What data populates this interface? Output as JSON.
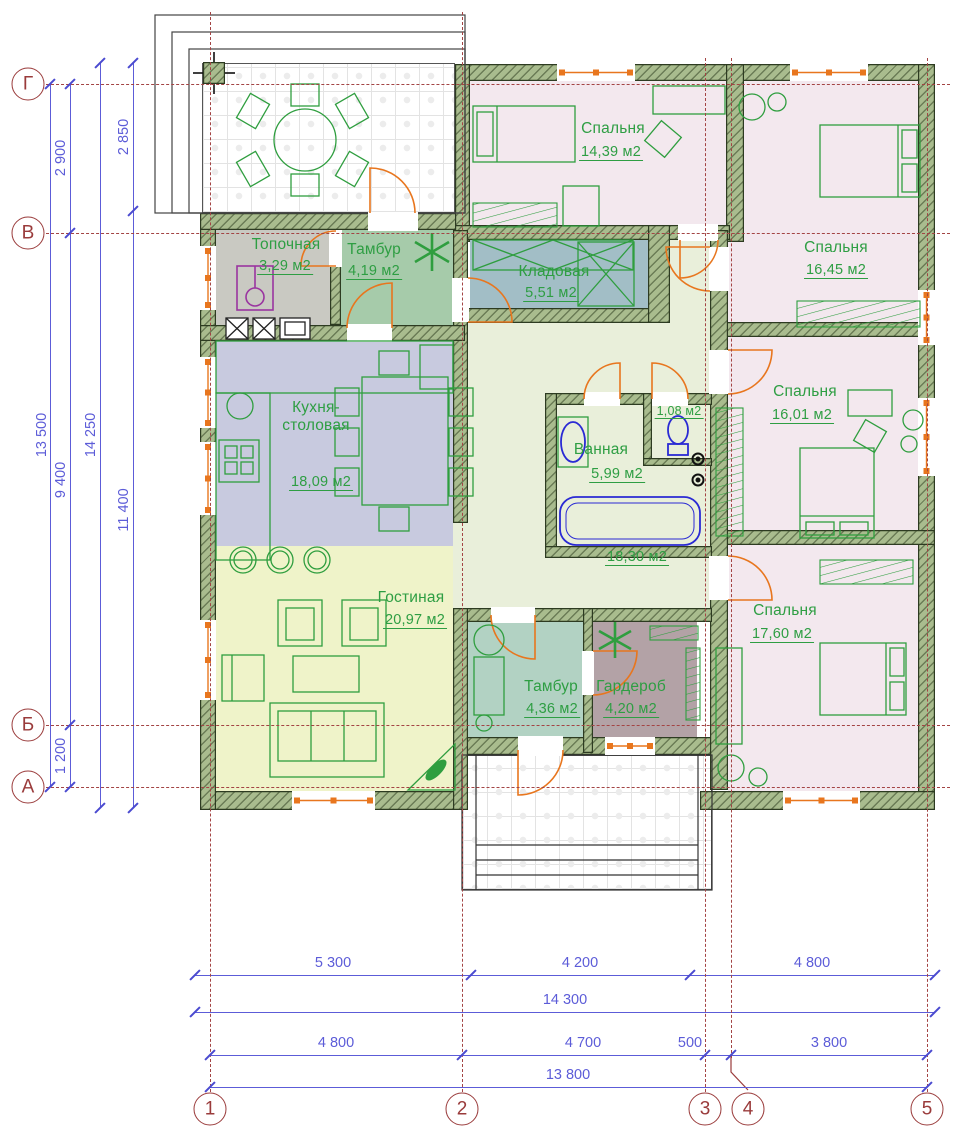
{
  "title": "План одноэтажного дома",
  "palette": {
    "wall_fill": "#a9bc8e",
    "wall_edge": "#2d3b21",
    "label_green": "#2e9e43",
    "dim_blue": "#5c5cd8",
    "axis_red": "#9a3b3b",
    "door_orange": "#e8761e",
    "fixture_blue": "#2a2ad4",
    "boiler_purple": "#9a35a0"
  },
  "rooms": [
    {
      "id": "topochnaya",
      "name": "Топочная",
      "area": "3,29 м2",
      "color": "#c9c9c2"
    },
    {
      "id": "tambur-top",
      "name": "Тамбур",
      "area": "4,19 м2",
      "color": "#a6cbaa"
    },
    {
      "id": "kladovaya",
      "name": "Кладовая",
      "area": "5,51 м2",
      "color": "#a2bec6"
    },
    {
      "id": "bedroom-1",
      "name": "Спальня",
      "area": "14,39 м2",
      "color": "#f3e8ee"
    },
    {
      "id": "bedroom-2",
      "name": "Спальня",
      "area": "16,45 м2",
      "color": "#f3e8ee"
    },
    {
      "id": "bedroom-3",
      "name": "Спальня",
      "area": "16,01 м2",
      "color": "#f3e8ee"
    },
    {
      "id": "bathroom",
      "name": "Ванная",
      "area": "5,99 м2",
      "color": "#cab3ae"
    },
    {
      "id": "wc",
      "name": "",
      "area": "1,08 м2",
      "color": "#cab3ae"
    },
    {
      "id": "hall",
      "name": "",
      "area": "18,30 м2",
      "color": "#e9efda"
    },
    {
      "id": "kitchen",
      "name": "Кухня-столовая",
      "name_line1": "Кухня-",
      "name_line2": "столовая",
      "area": "18,09 м2",
      "color": "#c8cadf"
    },
    {
      "id": "living",
      "name": "Гостиная",
      "area": "20,97 м2",
      "color": "#eff3c9"
    },
    {
      "id": "tambur-bottom",
      "name": "Тамбур",
      "area": "4,36 м2",
      "color": "#b2d2c3"
    },
    {
      "id": "wardrobe",
      "name": "Гардероб",
      "area": "4,20 м2",
      "color": "#b3a2a6"
    },
    {
      "id": "bedroom-4",
      "name": "Спальня",
      "area": "17,60 м2",
      "color": "#f3e8ee"
    }
  ],
  "axes": {
    "horizontal": [
      "Г",
      "В",
      "Б",
      "А"
    ],
    "vertical": [
      "1",
      "2",
      "3",
      "4",
      "5"
    ]
  },
  "dimensions": {
    "left": {
      "outer_total": "13 500",
      "segments": [
        "2 900",
        "9 400",
        "1 200"
      ],
      "inner_total": "14 250",
      "right_col": [
        "2 850",
        "11 400"
      ]
    },
    "bottom": {
      "row1": [
        "5 300",
        "4 200",
        "4 800"
      ],
      "row2_total": "14 300",
      "row3": [
        "4 800",
        "4 700",
        "500",
        "3 800"
      ],
      "row4_total": "13 800"
    }
  }
}
